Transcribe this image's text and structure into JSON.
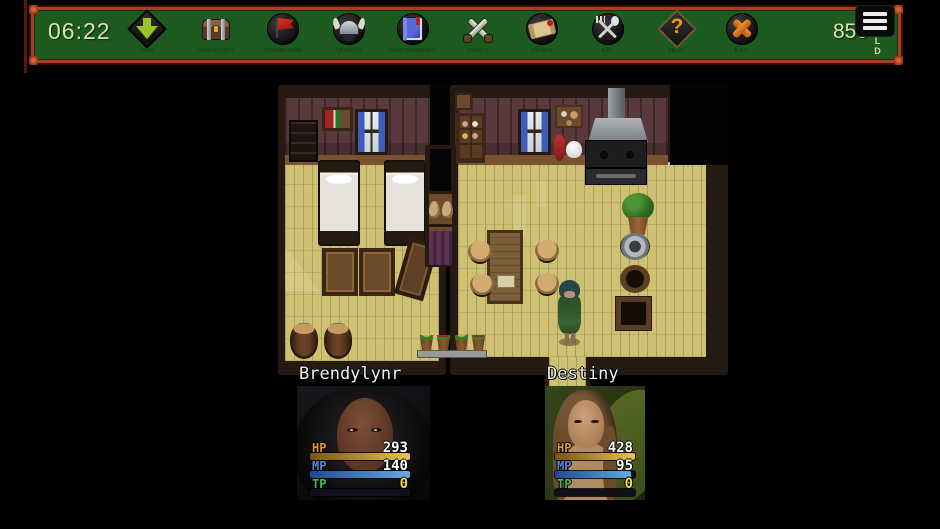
{
  "toolbar": {
    "time": "06:22",
    "items": [
      {
        "label": "MAP"
      },
      {
        "label": "INVENTORY"
      },
      {
        "label": "FORMATION"
      },
      {
        "label": "QUESTS"
      },
      {
        "label": "PHOTOLIBRARY"
      },
      {
        "label": "CRAFT"
      },
      {
        "label": "SKILLS"
      },
      {
        "label": "EAT"
      },
      {
        "label": "HELP",
        "glyph": "?"
      },
      {
        "label": "EXIT"
      }
    ],
    "gold": {
      "amount": "850",
      "unit": "GOLD"
    }
  },
  "party": [
    {
      "name": "Brendylynr",
      "hp": {
        "label": "HP",
        "value": "293",
        "fill": 100
      },
      "mp": {
        "label": "MP",
        "value": "140",
        "fill": 100
      },
      "tp": {
        "label": "TP",
        "value": "0",
        "fill": 0
      }
    },
    {
      "name": "Destiny",
      "hp": {
        "label": "HP",
        "value": "428",
        "fill": 100
      },
      "mp": {
        "label": "MP",
        "value": "95",
        "fill": 95
      },
      "tp": {
        "label": "TP",
        "value": "0",
        "fill": 0
      }
    }
  ],
  "colors": {
    "toolbar_bg": "#1d5a1f",
    "toolbar_border": "#a8401f",
    "time_text": "#d9e6a6",
    "hp_bar": "#e8c44c",
    "mp_bar": "#64aae0",
    "tp_value": "#e8e048"
  }
}
